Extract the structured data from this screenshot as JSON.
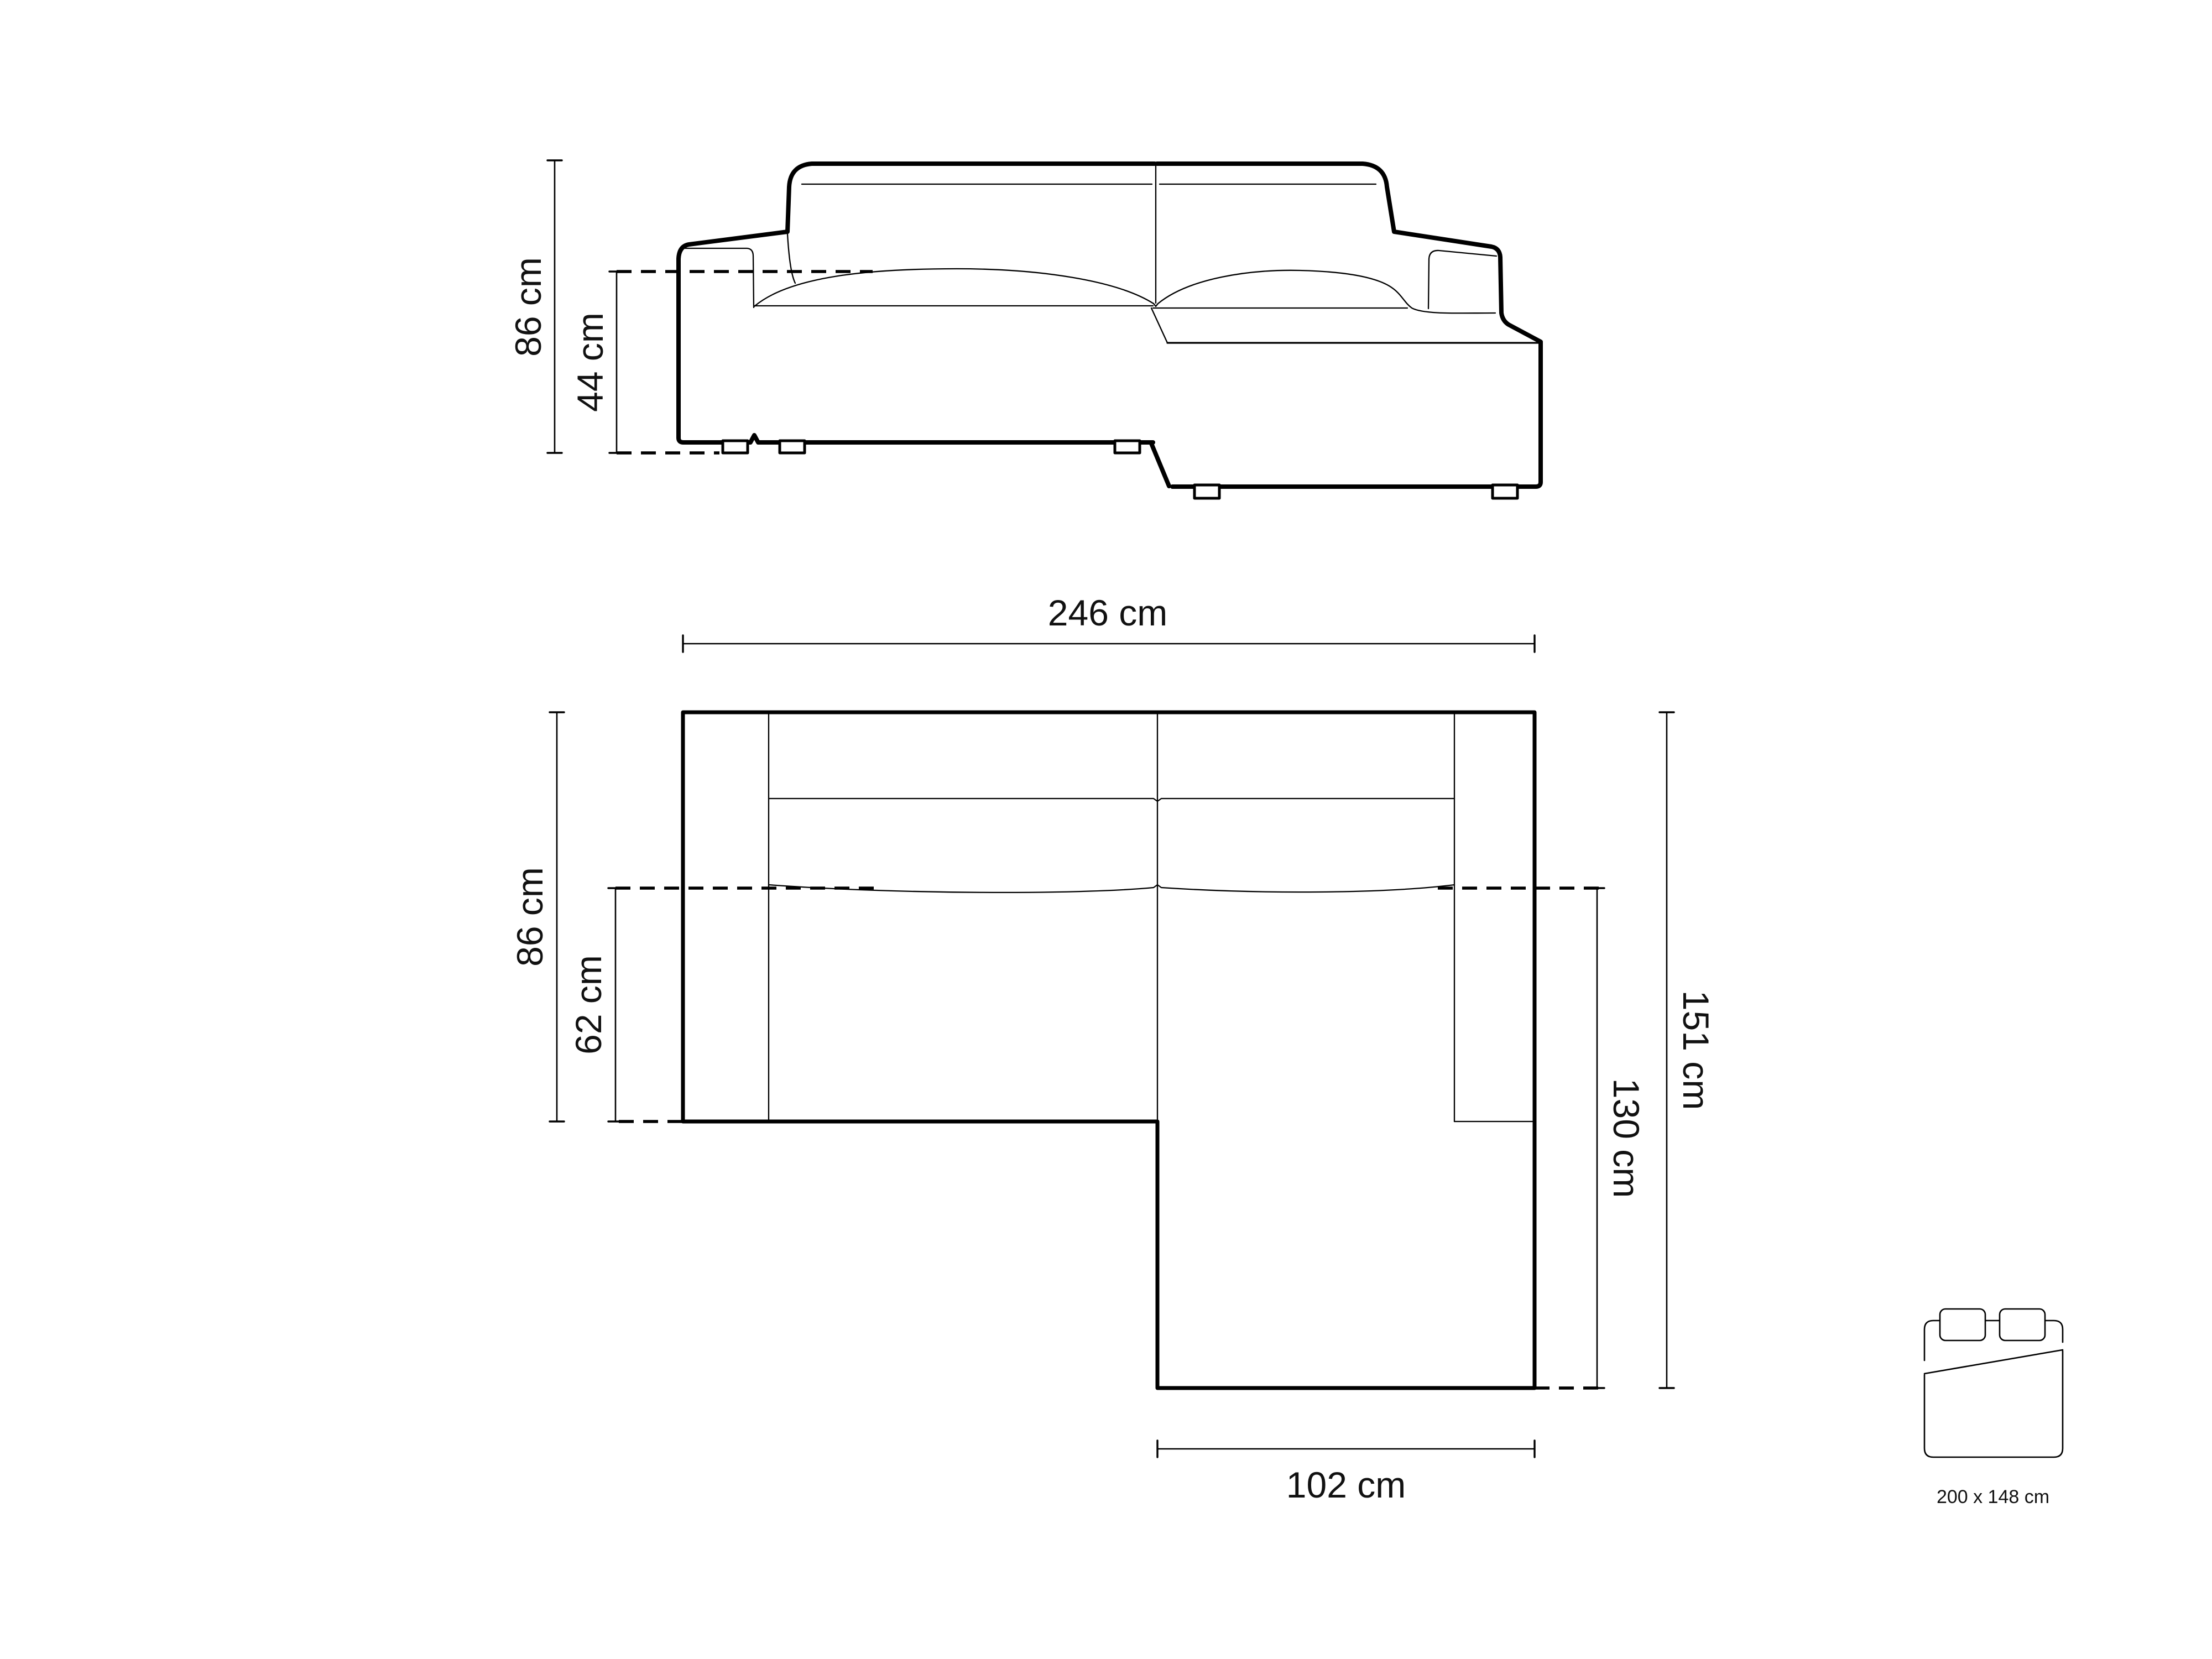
{
  "page": {
    "background": "#ffffff",
    "line_color": "#000000",
    "text_color": "#111111"
  },
  "front_view": {
    "description": "corner sofa front elevation drawing",
    "dims": {
      "total_height": "86 cm",
      "seat_height": "44 cm"
    }
  },
  "top_view": {
    "description": "corner sofa top plan drawing",
    "dims": {
      "total_width": "246 cm",
      "body_depth": "86 cm",
      "seat_depth": "62 cm",
      "total_depth": "151 cm",
      "chaise_depth": "130 cm",
      "chaise_width": "102 cm"
    }
  },
  "bed_icon": {
    "label": "200 x 148 cm"
  }
}
